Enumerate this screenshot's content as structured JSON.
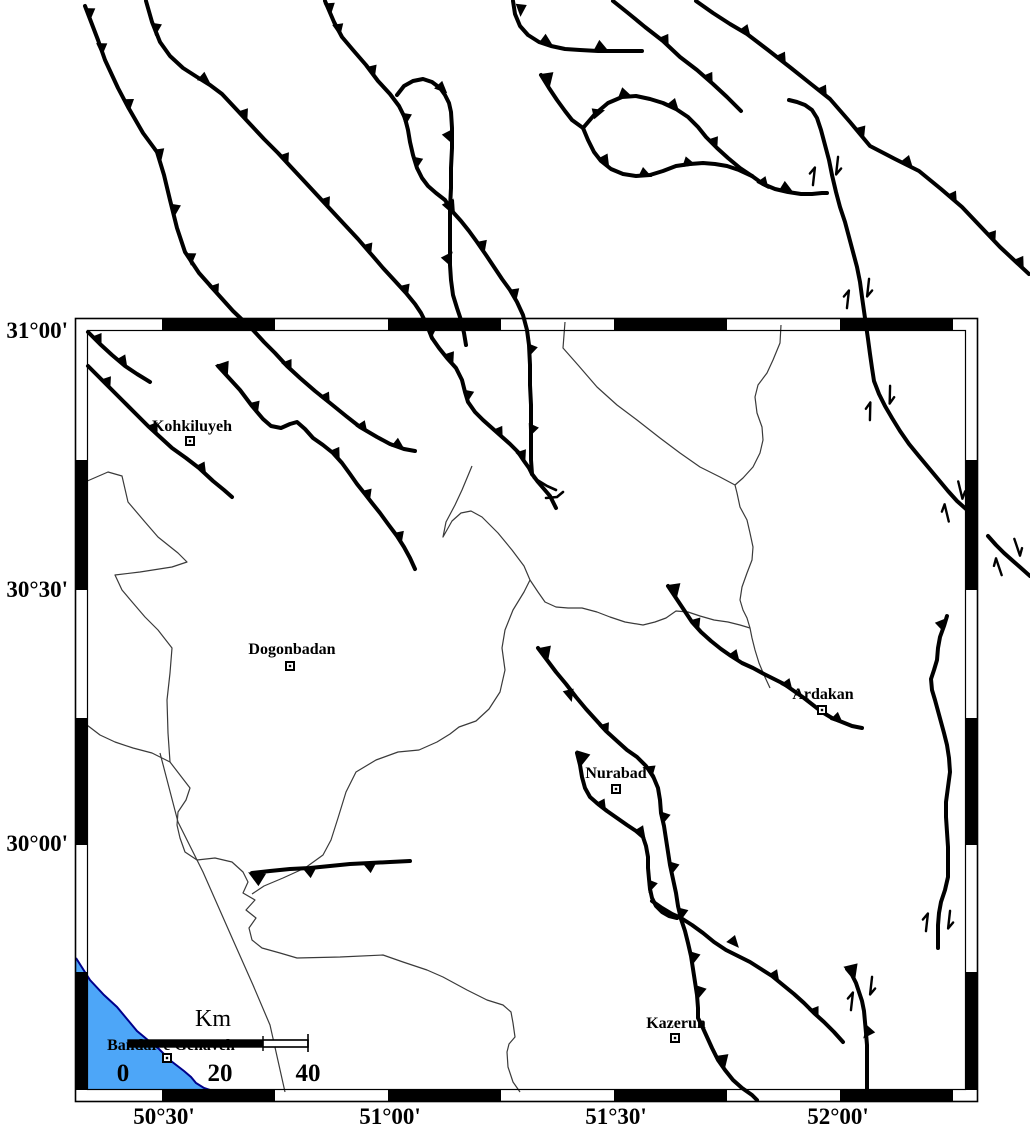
{
  "map": {
    "cities": [
      {
        "name": "Kohkiluyeh"
      },
      {
        "name": "Dogonbadan"
      },
      {
        "name": "Ardakan"
      },
      {
        "name": "Nurabad"
      },
      {
        "name": "Kazerun"
      },
      {
        "name": "Bandar-e Genaveh"
      }
    ],
    "axis": {
      "lat": [
        {
          "label": "31°00'"
        },
        {
          "label": "30°30'"
        },
        {
          "label": "30°00'"
        }
      ],
      "lon": [
        {
          "label": "50°30'"
        },
        {
          "label": "51°00'"
        },
        {
          "label": "51°30'"
        },
        {
          "label": "52°00'"
        }
      ]
    },
    "scalebar": {
      "unit": "Km",
      "tick0": "0",
      "tick1": "20",
      "tick2": "40"
    },
    "colors": {
      "sea_fill": "#4DA6F8",
      "sea_outline": "#00008B",
      "fault": "#000000",
      "river": "#3A3A3A",
      "frame": "#000000",
      "background": "#FFFFFF"
    }
  }
}
